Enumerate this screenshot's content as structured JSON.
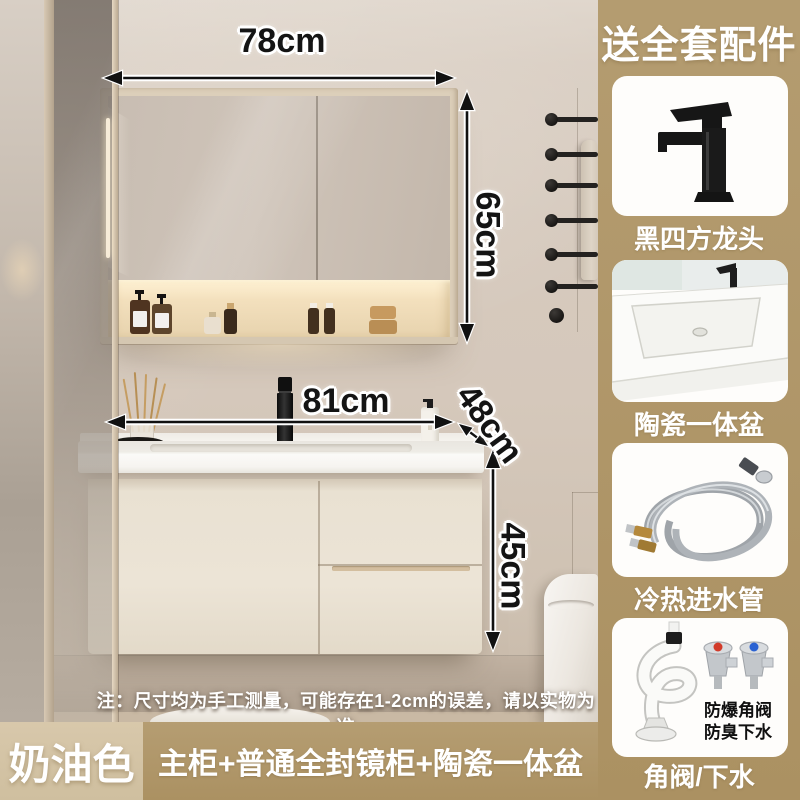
{
  "sidebar": {
    "title": "送全套配件",
    "bg_color": "#ae9468",
    "cards": [
      {
        "icon": "black-square-faucet-icon",
        "label": "黑四方龙头"
      },
      {
        "icon": "ceramic-basin-icon",
        "label": "陶瓷一体盆"
      },
      {
        "icon": "water-inlet-hoses-icon",
        "label": "冷热进水管"
      },
      {
        "icon": "angle-valve-drain-icon",
        "label": "角阀/下水",
        "badge_lines": [
          "防爆角阀",
          "防臭下水"
        ]
      }
    ]
  },
  "scene": {
    "dimensions": {
      "mirror_width": "78cm",
      "mirror_height": "65cm",
      "vanity_width": "81cm",
      "vanity_depth": "48cm",
      "vanity_height": "45cm"
    },
    "note": "注：尺寸均为手工测量，可能存在1-2cm的误差，请以实物为准"
  },
  "bottom_bar": {
    "color_name": "奶油色",
    "configuration": "主柜+普通全封镜柜+陶瓷一体盆",
    "left_bg": "#d5c5a6",
    "right_bg": "#b0976a"
  }
}
